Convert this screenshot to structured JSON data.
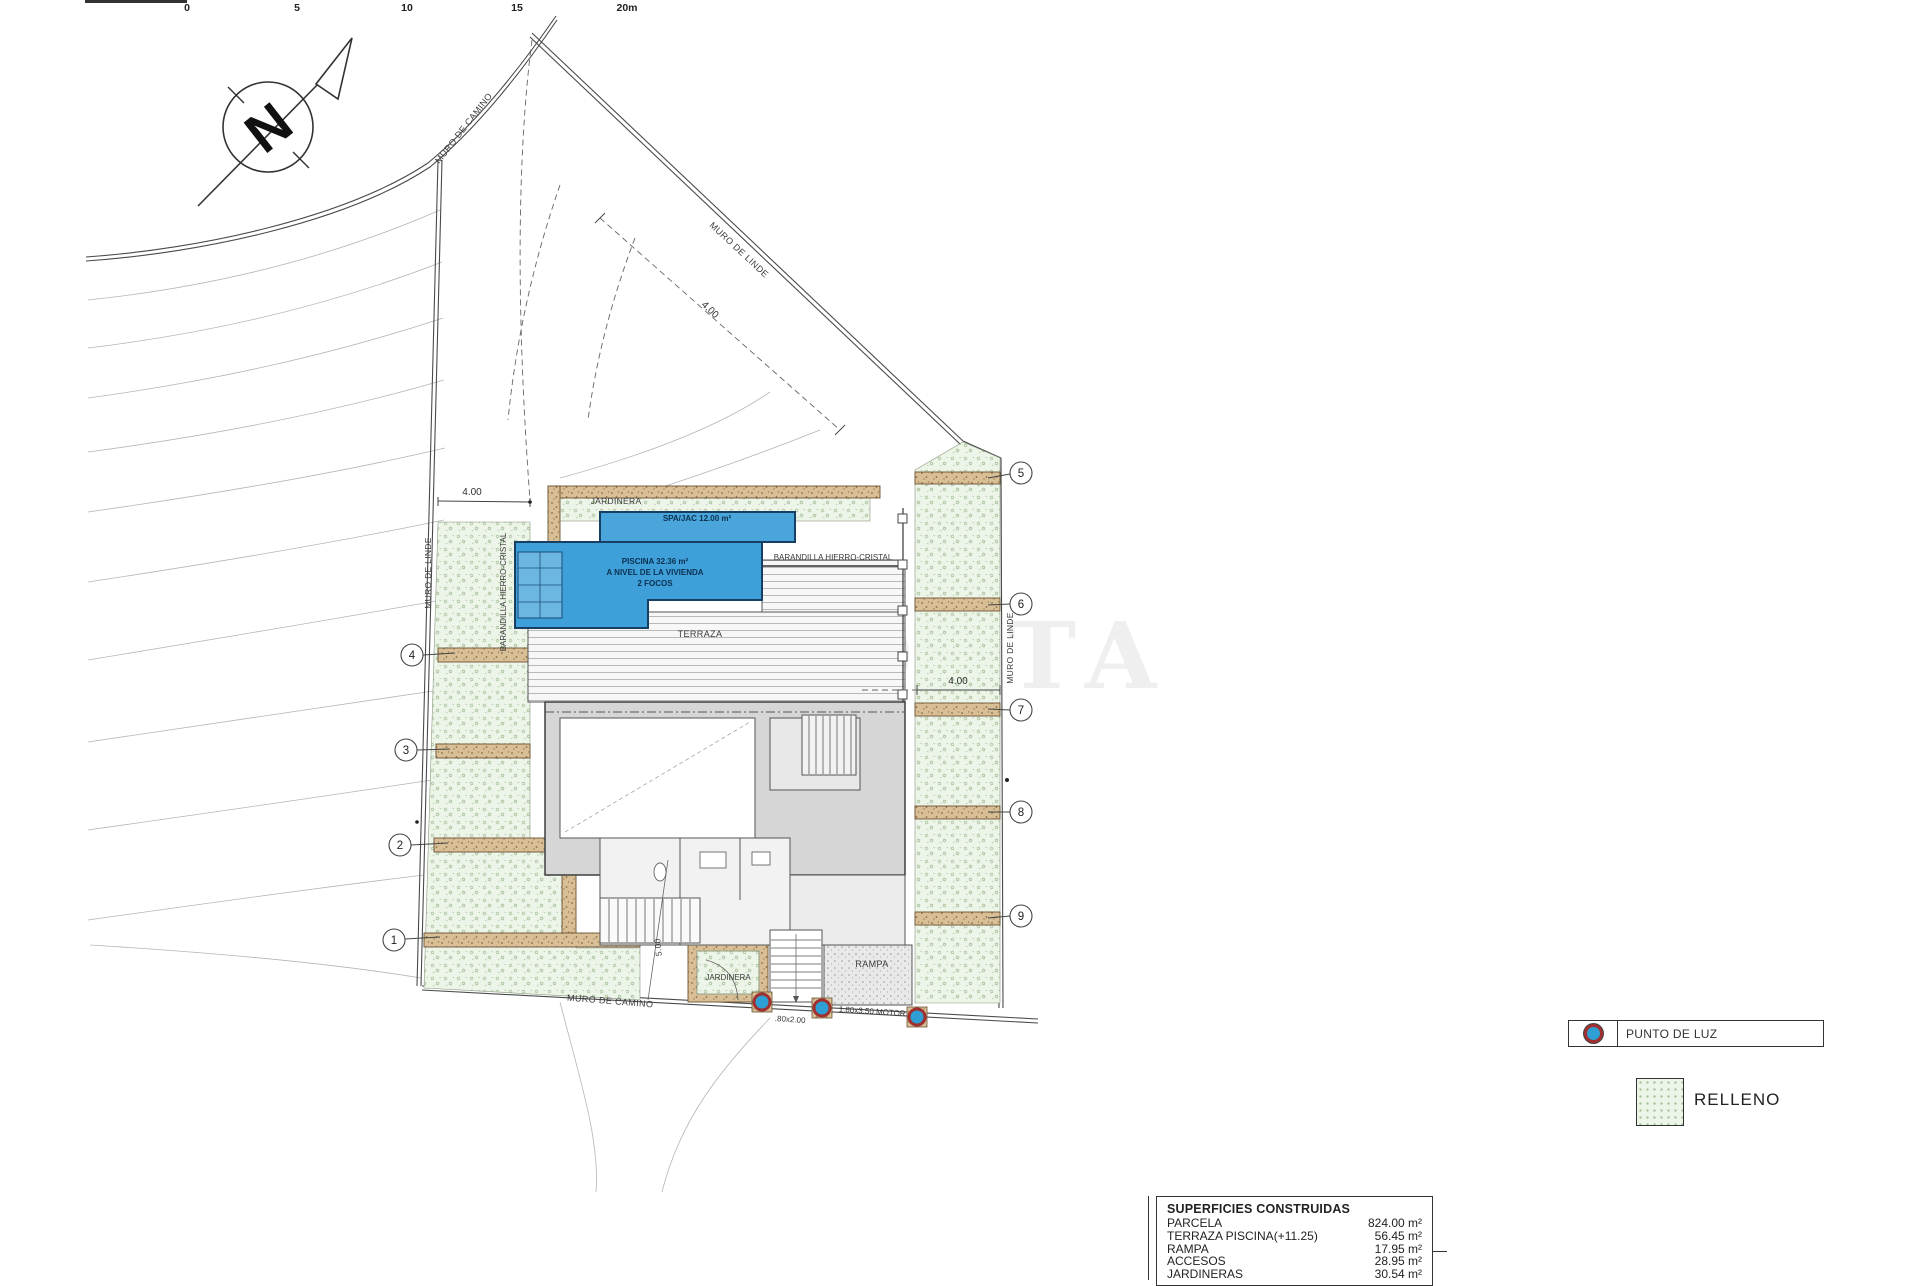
{
  "scale_bar": {
    "ticks": [
      "0",
      "5",
      "10",
      "15",
      "20m"
    ]
  },
  "north": {
    "label": "N"
  },
  "labels": {
    "muro_camino_top": "MURO DE CAMINO",
    "muro_linde_diag": "MURO DE LINDE",
    "muro_linde_left": "MURO DE LINDE",
    "muro_linde_right": "MURO DE LINDE",
    "muro_camino_bottom": "MURO DE CAMINO",
    "jardinera_top": "JARDINERA",
    "jardinera_bottom": "JARDINERA",
    "terraza": "TERRAZA",
    "rampa": "RAMPA",
    "barandilla_h": "BARANDILLA HIERRO-CRISTAL",
    "barandilla_v": "BARANDILLA HIERRO-CRISTAL",
    "spa": "SPA/JAC 12.00 m²",
    "piscina_line1": "PISCINA 32.36 m²",
    "piscina_line2": "A NIVEL DE LA VIVIENDA",
    "piscina_line3": "2 FOCOS",
    "dim_400_left": "4.00",
    "dim_400_diag": "4.00",
    "dim_400_right": "4.00",
    "dim_500_bottom": "5.00",
    "gate": ".80x2.00",
    "motor": "1.80x3.50 MOTOR",
    "watermark": "COSTA"
  },
  "markers": [
    "1",
    "2",
    "3",
    "4",
    "5",
    "6",
    "7",
    "8",
    "9"
  ],
  "legend": {
    "punto_de_luz": "PUNTO DE LUZ",
    "relleno": "RELLENO"
  },
  "table": {
    "title": "SUPERFICIES CONSTRUIDAS",
    "rows": [
      {
        "label": "PARCELA",
        "value": "824.00 m²"
      },
      {
        "label": "TERRAZA PISCINA(+11.25)",
        "value": "56.45 m²"
      },
      {
        "label": "RAMPA",
        "value": "17.95 m²"
      },
      {
        "label": "ACCESOS",
        "value": "28.95 m²"
      },
      {
        "label": "JARDINERAS",
        "value": "30.54 m²"
      }
    ]
  },
  "colors": {
    "pool_blue": "#3f9fd8",
    "pool_border": "#163f63",
    "relleno_green": "#edf4e8",
    "muro_tan": "#d9bf96",
    "punto_luz_blue": "#2e9fd4",
    "punto_luz_ring": "#a03030"
  }
}
